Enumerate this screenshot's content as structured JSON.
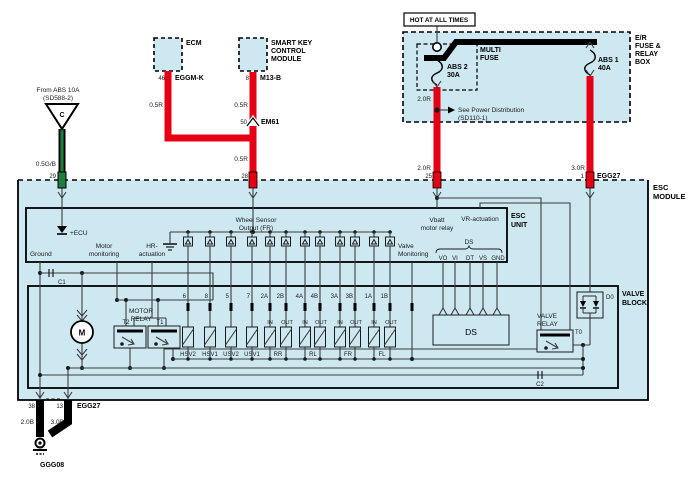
{
  "colors": {
    "panel_blue": "#cde8f1",
    "wire_red": "#e60014",
    "wire_green": "#1f7e3d",
    "wire_gray": "#3c3c3c",
    "wire_black": "#000000"
  },
  "abs_feed": {
    "from_line1": "From ABS 10A",
    "from_line2": "(SD588-2)",
    "letter": "C",
    "wire": "0.5G/B",
    "pin": "29"
  },
  "ecm": {
    "name": "ECM",
    "pin": "46",
    "conn": "EGGM-K",
    "wire": "0.5R"
  },
  "skcm": {
    "line1": "SMART KEY",
    "line2": "CONTROL",
    "line3": "MODULE",
    "pin": "8",
    "conn": "M13-B",
    "wire1": "0.5R",
    "jpin": "50",
    "jname": "EM61",
    "wire2": "0.5R",
    "mpin": "28"
  },
  "fusebox": {
    "hot": "HOT AT ALL TIMES",
    "n1": "E/R",
    "n2": "FUSE &",
    "n3": "RELAY",
    "n4": "BOX",
    "mf1": "MULTI",
    "mf2": "FUSE",
    "f2a": "ABS 2",
    "f2b": "30A",
    "f1a": "ABS 1",
    "f1b": "40A",
    "see1": "See Power Distribution",
    "see2": "(SD110-1)",
    "w2a": "2.0R",
    "w2b": "2.0R",
    "p2": "25",
    "w1": "3.0R",
    "p1": "1",
    "conn": "EGG27"
  },
  "module": {
    "n1": "ESC",
    "n2": "MODULE"
  },
  "unit": {
    "n1": "ESC",
    "n2": "UNIT",
    "ecu": "+ECU",
    "ground": "Ground",
    "mm1": "Motor",
    "mm2": "monitoring",
    "hr1": "HR-",
    "hr2": "actuation",
    "ws1": "Wheel Sensor",
    "ws2": "Output (FR)",
    "vm1": "Valve",
    "vm2": "Monitoring",
    "vb1": "Vbatt",
    "vb2": "motor relay",
    "vr": "VR-actuation",
    "ds": "DS",
    "ds_pins": [
      "VO",
      "VI",
      "DT",
      "VS",
      "GND"
    ]
  },
  "valveblock": {
    "n1": "VALVE",
    "n2": "BLOCK",
    "pins": [
      "6",
      "8",
      "5",
      "7",
      "2A",
      "2B",
      "4A",
      "4B",
      "3A",
      "3B",
      "1A",
      "1B"
    ],
    "flow": [
      "IN",
      "OUT",
      "IN",
      "OUT",
      "IN",
      "OUT",
      "IN",
      "OUT"
    ],
    "names": [
      "HSV2",
      "HSV1",
      "USV2",
      "USV1",
      "RR",
      "RL",
      "FR",
      "FL"
    ],
    "ds": "DS",
    "mr1": "MOTOR",
    "mr2": "RELAY",
    "t2": "T2",
    "t1": "T1",
    "vr1": "VALVE",
    "vr2": "RELAY",
    "t0": "T0",
    "d0": "D0",
    "m": "M",
    "c1": "C1",
    "c2": "C2"
  },
  "ground": {
    "p38": "38",
    "p13": "13",
    "conn": "EGG27",
    "w38": "2.0B",
    "w13": "3.0B",
    "name": "GGG08"
  }
}
